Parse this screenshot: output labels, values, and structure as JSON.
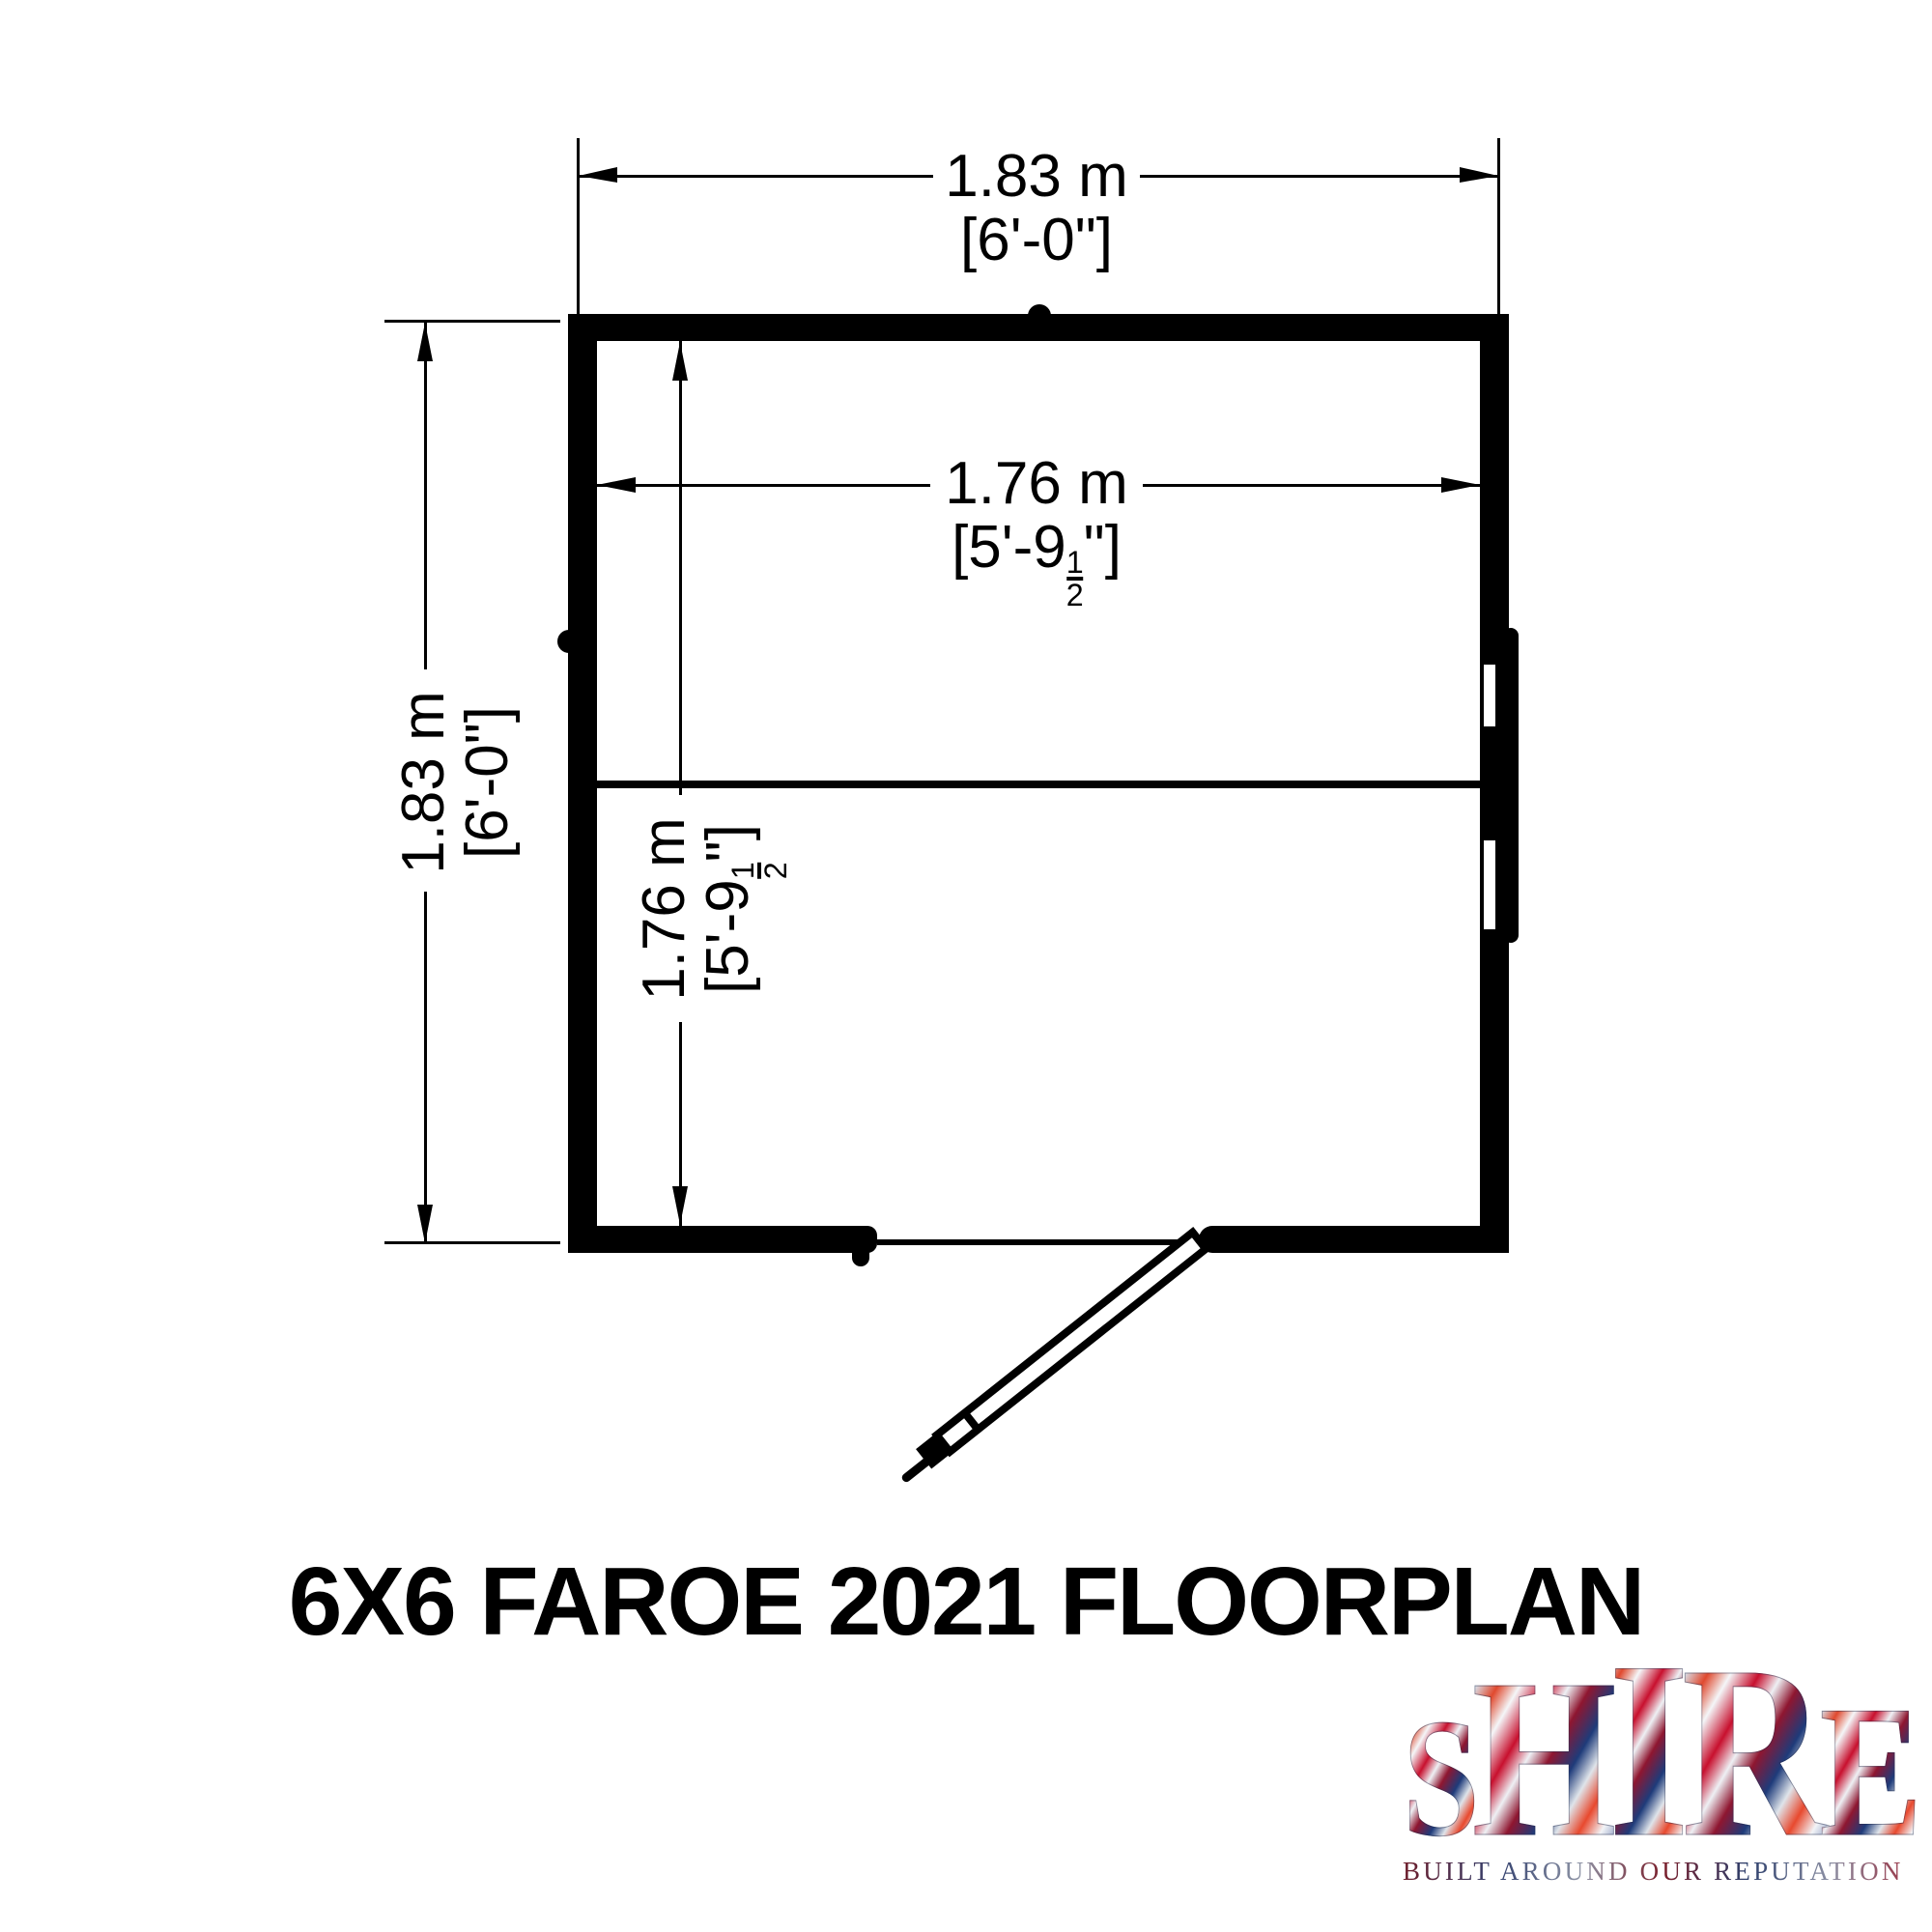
{
  "title": "6X6 FAROE 2021 FLOORPLAN",
  "dims": {
    "overall_width": {
      "metric": "1.83 m",
      "imperial": "[6'-0\"]"
    },
    "overall_depth": {
      "metric": "1.83 m",
      "imperial": "[6'-0\"]"
    },
    "internal_width": {
      "metric": "1.76 m",
      "imp_prefix": "[5'-9",
      "frac_num": "1",
      "frac_den": "2",
      "imp_suffix": "\"]"
    },
    "internal_depth": {
      "metric": "1.76 m",
      "imp_prefix": "[5'-9",
      "frac_num": "1",
      "frac_den": "2",
      "imp_suffix": "\"]"
    }
  },
  "logo": {
    "l1": "S",
    "l2": "H",
    "l3": "I",
    "l4": "R",
    "l5": "E",
    "tagline": "BUILT AROUND OUR REPUTATION"
  },
  "colors": {
    "ink": "#000000",
    "paper": "#ffffff",
    "flag_red": "#c8102e",
    "flag_blue": "#27408b",
    "flag_silver": "#dfe4ec"
  }
}
